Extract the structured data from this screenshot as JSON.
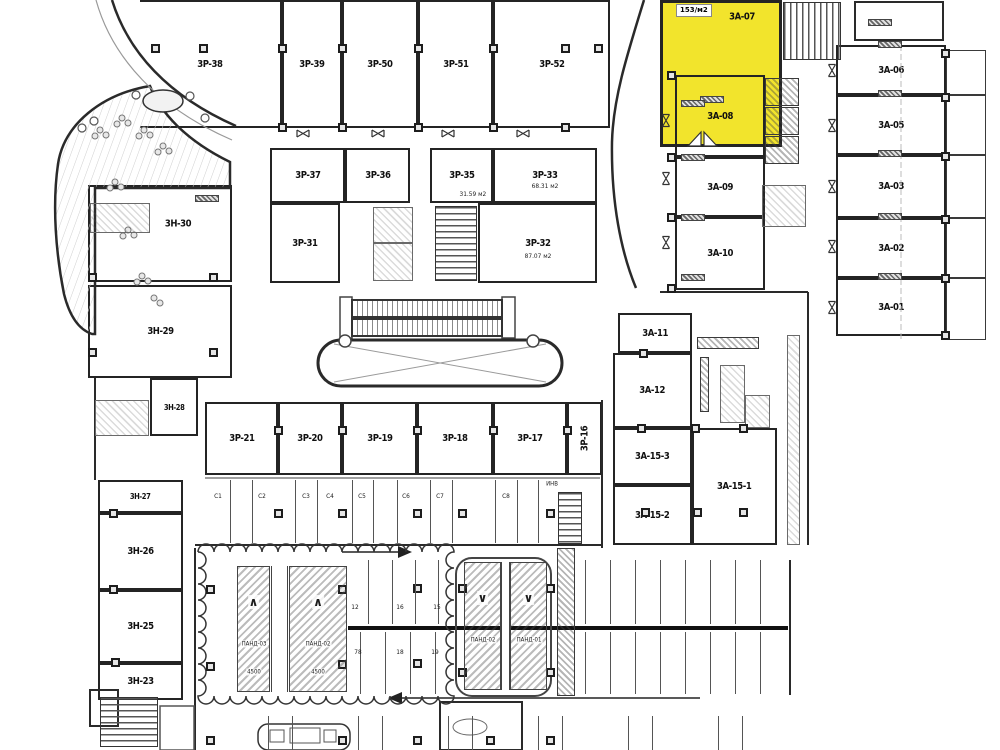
{
  "plan": {
    "title": "floor-plan",
    "colors": {
      "highlight": "#F2E42C",
      "line": "#242424",
      "hatch": "#8a8a8a"
    },
    "highlighted_unit": {
      "id": "3A-07",
      "area_label": "153/м2"
    },
    "rooms": [
      {
        "id": "3P-38",
        "x": 140,
        "y": 0,
        "w": 142,
        "h": 128,
        "noLeft": true
      },
      {
        "id": "3P-39",
        "x": 282,
        "y": 0,
        "w": 60,
        "h": 128
      },
      {
        "id": "3P-50",
        "x": 342,
        "y": 0,
        "w": 76,
        "h": 128
      },
      {
        "id": "3P-51",
        "x": 418,
        "y": 0,
        "w": 75,
        "h": 128
      },
      {
        "id": "3P-52",
        "x": 493,
        "y": 0,
        "w": 117,
        "h": 128
      },
      {
        "id": "3A-07",
        "x": 660,
        "y": 0,
        "w": 122,
        "h": 147,
        "highlight": true,
        "lx": 0.68,
        "ly": 0.1
      },
      {
        "id": "3A-06",
        "x": 836,
        "y": 45,
        "w": 110,
        "h": 50
      },
      {
        "id": "3A-05",
        "x": 836,
        "y": 95,
        "w": 110,
        "h": 60
      },
      {
        "id": "3A-03",
        "x": 836,
        "y": 155,
        "w": 110,
        "h": 63
      },
      {
        "id": "3A-02",
        "x": 836,
        "y": 218,
        "w": 110,
        "h": 60
      },
      {
        "id": "3A-01",
        "x": 836,
        "y": 278,
        "w": 110,
        "h": 58
      },
      {
        "id": "3A-08",
        "x": 675,
        "y": 75,
        "w": 90,
        "h": 82
      },
      {
        "id": "3A-09",
        "x": 675,
        "y": 157,
        "w": 90,
        "h": 60
      },
      {
        "id": "3A-10",
        "x": 675,
        "y": 217,
        "w": 90,
        "h": 73
      },
      {
        "id": "3P-37",
        "x": 270,
        "y": 148,
        "w": 75,
        "h": 55
      },
      {
        "id": "3P-36",
        "x": 345,
        "y": 148,
        "w": 65,
        "h": 55
      },
      {
        "id": "3P-31",
        "x": 270,
        "y": 203,
        "w": 70,
        "h": 80
      },
      {
        "id": "3P-35",
        "x": 430,
        "y": 148,
        "w": 63,
        "h": 55,
        "area": "31.59 м2",
        "areaPos": "br"
      },
      {
        "id": "3P-33",
        "x": 493,
        "y": 148,
        "w": 104,
        "h": 55,
        "area": "68.31 м2"
      },
      {
        "id": "3P-32",
        "x": 478,
        "y": 203,
        "w": 119,
        "h": 80,
        "area": "87.07 м2"
      },
      {
        "id": "3H-30",
        "x": 88,
        "y": 185,
        "w": 144,
        "h": 97,
        "lx": 0.63,
        "ly": 0.4
      },
      {
        "id": "3H-29",
        "x": 88,
        "y": 285,
        "w": 144,
        "h": 93
      },
      {
        "id": "3H-28",
        "x": 150,
        "y": 378,
        "w": 48,
        "h": 58
      },
      {
        "id": "3H-27",
        "x": 98,
        "y": 480,
        "w": 85,
        "h": 33
      },
      {
        "id": "3H-26",
        "x": 98,
        "y": 513,
        "w": 85,
        "h": 77
      },
      {
        "id": "3H-25",
        "x": 98,
        "y": 590,
        "w": 85,
        "h": 73
      },
      {
        "id": "3H-23",
        "x": 98,
        "y": 663,
        "w": 85,
        "h": 37
      },
      {
        "id": "3P-21",
        "x": 205,
        "y": 402,
        "w": 73,
        "h": 73
      },
      {
        "id": "3P-20",
        "x": 278,
        "y": 402,
        "w": 64,
        "h": 73
      },
      {
        "id": "3P-19",
        "x": 342,
        "y": 402,
        "w": 75,
        "h": 73
      },
      {
        "id": "3P-18",
        "x": 417,
        "y": 402,
        "w": 76,
        "h": 73
      },
      {
        "id": "3P-17",
        "x": 493,
        "y": 402,
        "w": 74,
        "h": 73
      },
      {
        "id": "3P-16",
        "x": 567,
        "y": 402,
        "w": 35,
        "h": 73,
        "vertical": true
      },
      {
        "id": "3A-11",
        "x": 618,
        "y": 313,
        "w": 74,
        "h": 40
      },
      {
        "id": "3A-12",
        "x": 613,
        "y": 353,
        "w": 79,
        "h": 75
      },
      {
        "id": "3A-15-3",
        "x": 613,
        "y": 428,
        "w": 79,
        "h": 57
      },
      {
        "id": "3A-15-2",
        "x": 613,
        "y": 485,
        "w": 79,
        "h": 60
      },
      {
        "id": "3A-15-1",
        "x": 692,
        "y": 428,
        "w": 85,
        "h": 117
      }
    ],
    "balconies": [
      {
        "x": 946,
        "y": 50,
        "w": 40,
        "h": 45
      },
      {
        "x": 946,
        "y": 95,
        "w": 40,
        "h": 60
      },
      {
        "x": 946,
        "y": 155,
        "w": 40,
        "h": 63
      },
      {
        "x": 946,
        "y": 218,
        "w": 40,
        "h": 60
      },
      {
        "x": 946,
        "y": 278,
        "w": 40,
        "h": 62
      }
    ],
    "shafts": [
      {
        "x": 765,
        "y": 78,
        "w": 34,
        "h": 28
      },
      {
        "x": 765,
        "y": 107,
        "w": 34,
        "h": 28
      },
      {
        "x": 765,
        "y": 136,
        "w": 34,
        "h": 28
      },
      {
        "x": 762,
        "y": 185,
        "w": 44,
        "h": 42,
        "light": true
      },
      {
        "x": 697,
        "y": 337,
        "w": 62,
        "h": 12
      },
      {
        "x": 700,
        "y": 357,
        "w": 9,
        "h": 55
      },
      {
        "x": 720,
        "y": 365,
        "w": 25,
        "h": 58,
        "light": true
      },
      {
        "x": 745,
        "y": 395,
        "w": 25,
        "h": 33,
        "light": true
      },
      {
        "x": 557,
        "y": 548,
        "w": 18,
        "h": 148
      },
      {
        "x": 787,
        "y": 335,
        "w": 13,
        "h": 210,
        "light": true
      },
      {
        "x": 373,
        "y": 207,
        "w": 40,
        "h": 36,
        "light": true
      },
      {
        "x": 373,
        "y": 243,
        "w": 40,
        "h": 38,
        "light": true
      },
      {
        "x": 95,
        "y": 400,
        "w": 54,
        "h": 36,
        "light": true
      },
      {
        "x": 90,
        "y": 203,
        "w": 60,
        "h": 30,
        "light": true
      }
    ],
    "stairs": [
      {
        "x": 783,
        "y": 2,
        "w": 58,
        "h": 58,
        "dir": "h"
      },
      {
        "x": 435,
        "y": 206,
        "w": 42,
        "h": 75,
        "dir": "v"
      },
      {
        "x": 558,
        "y": 492,
        "w": 24,
        "h": 52,
        "dir": "v"
      },
      {
        "x": 100,
        "y": 697,
        "w": 58,
        "h": 50,
        "dir": "v"
      }
    ],
    "markers": [
      [
        155,
        48
      ],
      [
        203,
        48
      ],
      [
        282,
        48
      ],
      [
        342,
        48
      ],
      [
        418,
        48
      ],
      [
        493,
        48
      ],
      [
        565,
        48
      ],
      [
        598,
        48
      ],
      [
        282,
        127
      ],
      [
        342,
        127
      ],
      [
        418,
        127
      ],
      [
        493,
        127
      ],
      [
        565,
        127
      ],
      [
        92,
        277
      ],
      [
        213,
        277
      ],
      [
        92,
        352
      ],
      [
        213,
        352
      ],
      [
        113,
        513
      ],
      [
        113,
        589
      ],
      [
        115,
        662
      ],
      [
        278,
        430
      ],
      [
        342,
        430
      ],
      [
        417,
        430
      ],
      [
        493,
        430
      ],
      [
        567,
        430
      ],
      [
        278,
        513
      ],
      [
        342,
        513
      ],
      [
        417,
        513
      ],
      [
        462,
        513
      ],
      [
        550,
        513
      ],
      [
        645,
        512
      ],
      [
        697,
        512
      ],
      [
        743,
        512
      ],
      [
        641,
        428
      ],
      [
        695,
        428
      ],
      [
        743,
        428
      ],
      [
        643,
        353
      ],
      [
        945,
        53
      ],
      [
        945,
        97
      ],
      [
        945,
        156
      ],
      [
        945,
        219
      ],
      [
        945,
        278
      ],
      [
        945,
        335
      ],
      [
        671,
        75
      ],
      [
        671,
        157
      ],
      [
        671,
        217
      ],
      [
        671,
        288
      ],
      [
        210,
        589
      ],
      [
        210,
        666
      ],
      [
        342,
        589
      ],
      [
        342,
        664
      ],
      [
        417,
        588
      ],
      [
        417,
        663
      ],
      [
        462,
        588
      ],
      [
        462,
        672
      ],
      [
        550,
        588
      ],
      [
        550,
        672
      ],
      [
        210,
        740
      ],
      [
        342,
        740
      ],
      [
        417,
        740
      ],
      [
        490,
        740
      ],
      [
        550,
        740
      ]
    ],
    "pills": [
      [
        712,
        99
      ],
      [
        890,
        44
      ],
      [
        890,
        93
      ],
      [
        890,
        153
      ],
      [
        890,
        216
      ],
      [
        890,
        276
      ],
      [
        693,
        103
      ],
      [
        693,
        157
      ],
      [
        693,
        217
      ],
      [
        693,
        277
      ],
      [
        207,
        198
      ],
      [
        880,
        22
      ]
    ],
    "bowties": [
      {
        "x": 838,
        "y": 70,
        "v": true
      },
      {
        "x": 838,
        "y": 125,
        "v": true
      },
      {
        "x": 838,
        "y": 186,
        "v": true
      },
      {
        "x": 838,
        "y": 246,
        "v": true
      },
      {
        "x": 838,
        "y": 307,
        "v": true
      },
      {
        "x": 672,
        "y": 120,
        "v": true
      },
      {
        "x": 672,
        "y": 178,
        "v": true
      },
      {
        "x": 672,
        "y": 242,
        "v": true
      },
      {
        "x": 303,
        "y": 127,
        "v": false
      },
      {
        "x": 378,
        "y": 127,
        "v": false
      },
      {
        "x": 448,
        "y": 127,
        "v": false
      },
      {
        "x": 523,
        "y": 127,
        "v": false
      }
    ],
    "ramps": {
      "left_bars": [
        {
          "x": 237,
          "y": 566,
          "w": 33,
          "h": 126,
          "label": "ПАНД-03",
          "dim": "4500",
          "arrow": "∧"
        },
        {
          "x": 289,
          "y": 566,
          "w": 58,
          "h": 126,
          "label": "ПАНД-02",
          "dim": "4500",
          "arrow": "∧"
        }
      ],
      "left_divider": [
        271,
        566,
        17,
        126
      ],
      "right_bars": [
        {
          "x": 464,
          "y": 562,
          "w": 37,
          "h": 128,
          "label": "ПАНД-02",
          "arrow": "∨"
        },
        {
          "x": 510,
          "y": 562,
          "w": 37,
          "h": 128,
          "label": "ПАНД-01",
          "arrow": "∨"
        }
      ],
      "right_divider": [
        501,
        562,
        9,
        128
      ]
    },
    "parking": {
      "stall_labels": [
        {
          "t": "C1",
          "x": 218
        },
        {
          "t": "C2",
          "x": 262
        },
        {
          "t": "C3",
          "x": 306
        },
        {
          "t": "C4",
          "x": 330
        },
        {
          "t": "C5",
          "x": 362
        },
        {
          "t": "C6",
          "x": 406
        },
        {
          "t": "C7",
          "x": 440
        },
        {
          "t": "C8",
          "x": 506
        }
      ],
      "stall_label_y": 496,
      "bay_numbers": [
        {
          "t": "12",
          "x": 355,
          "y": 607
        },
        {
          "t": "16",
          "x": 400,
          "y": 607
        },
        {
          "t": "15",
          "x": 437,
          "y": 607
        },
        {
          "t": "78",
          "x": 358,
          "y": 652
        },
        {
          "t": "18",
          "x": 400,
          "y": 652
        },
        {
          "t": "19",
          "x": 435,
          "y": 652
        }
      ],
      "disabled_label": {
        "t": "ИНВ",
        "x": 552,
        "y": 484
      }
    }
  }
}
